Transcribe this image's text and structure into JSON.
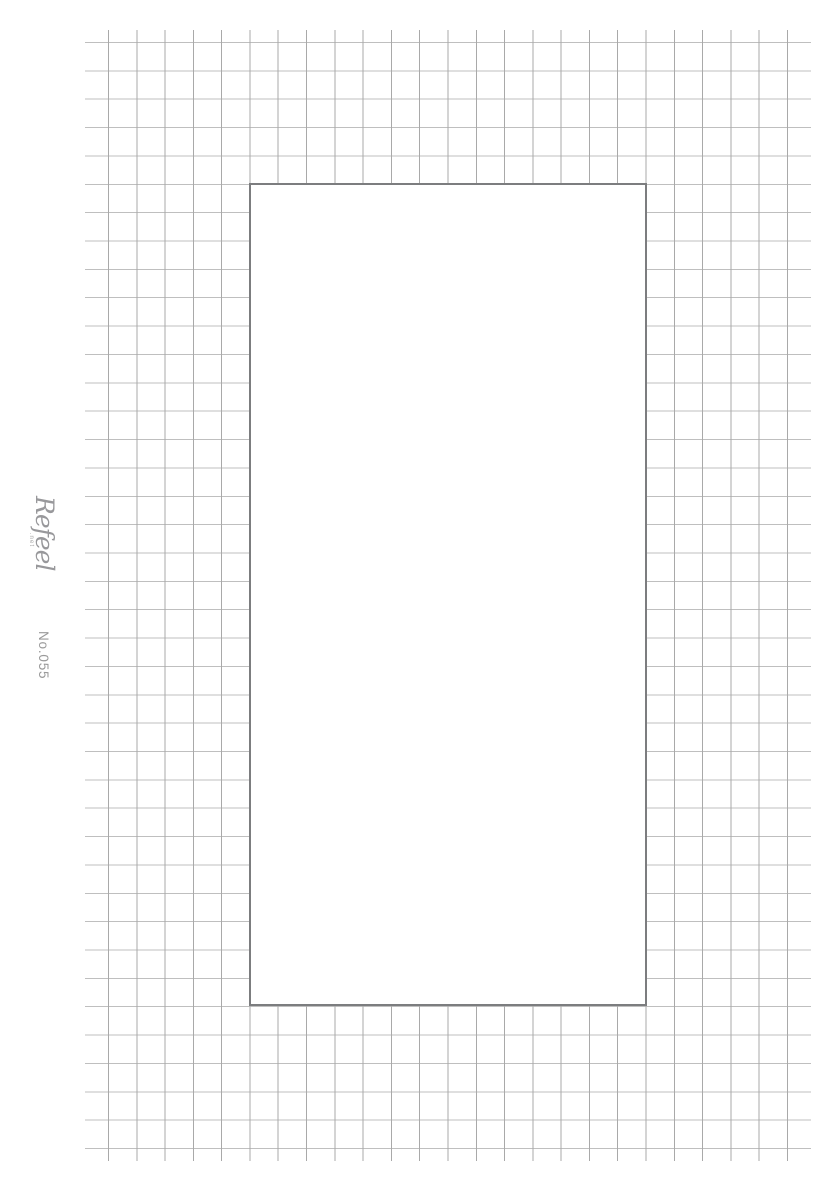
{
  "sheet": {
    "logo": {
      "text": "Refeel",
      "suffix": ".net"
    },
    "refill_number": "No.055",
    "colors": {
      "background": "#ffffff",
      "grid_line_vertical": "#a9a9a9",
      "grid_line_horizontal": "#bfbfbf",
      "frame_border": "#7c7d7f",
      "side_text": "#9a9a9a"
    },
    "grid": {
      "columns": 24,
      "rows": 39,
      "cell_px": 28.3
    }
  }
}
